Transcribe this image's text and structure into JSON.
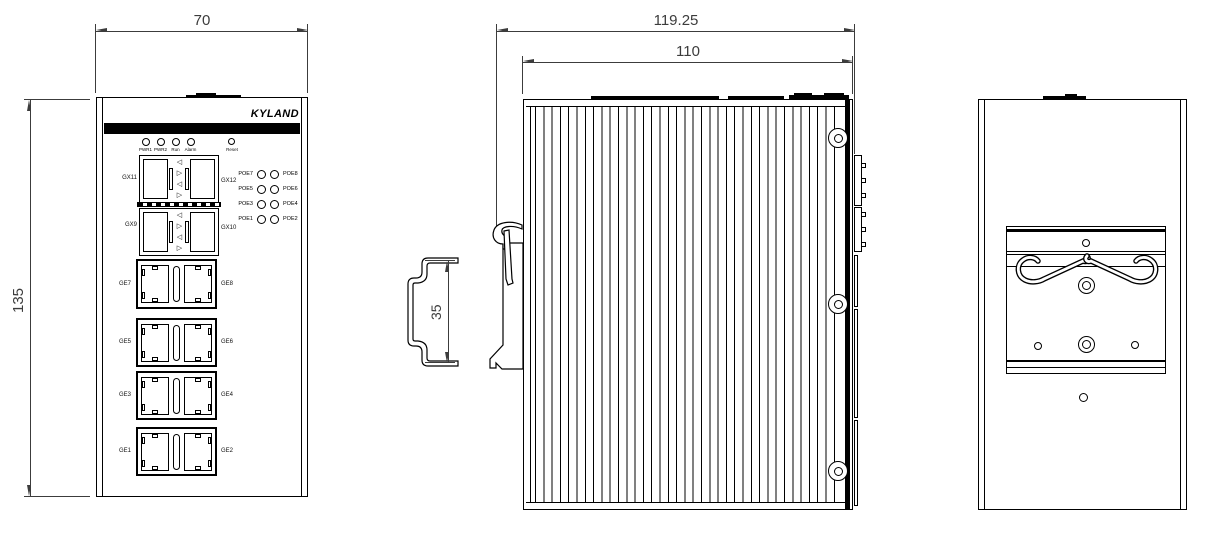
{
  "brand": "KYLAND",
  "dimensions": {
    "front_width": "70",
    "front_height": "135",
    "side_overall_depth": "119.25",
    "side_body_depth": "110",
    "din_rail_height": "35"
  },
  "front": {
    "status_leds": [
      "PWR1",
      "PWR2",
      "Run",
      "Alarm"
    ],
    "reset_label": "Reset",
    "sfp_arrows": [
      "◁",
      "▷",
      "◁",
      "▷"
    ],
    "sfp_rows": [
      {
        "left": "GX11",
        "right": "GX12"
      },
      {
        "left": "GX9",
        "right": "GX10"
      }
    ],
    "poe_rows": [
      {
        "left": "POE7",
        "right": "POE8"
      },
      {
        "left": "POE5",
        "right": "POE6"
      },
      {
        "left": "POE3",
        "right": "POE4"
      },
      {
        "left": "POE1",
        "right": "POE2"
      }
    ],
    "ge_rows": [
      {
        "left": "GE7",
        "right": "GE8"
      },
      {
        "left": "GE5",
        "right": "GE6"
      },
      {
        "left": "GE3",
        "right": "GE4"
      },
      {
        "left": "GE1",
        "right": "GE2"
      }
    ]
  },
  "colors": {
    "object_line": "#000000",
    "dimension_line": "#3c3c3c",
    "background": "#ffffff"
  }
}
